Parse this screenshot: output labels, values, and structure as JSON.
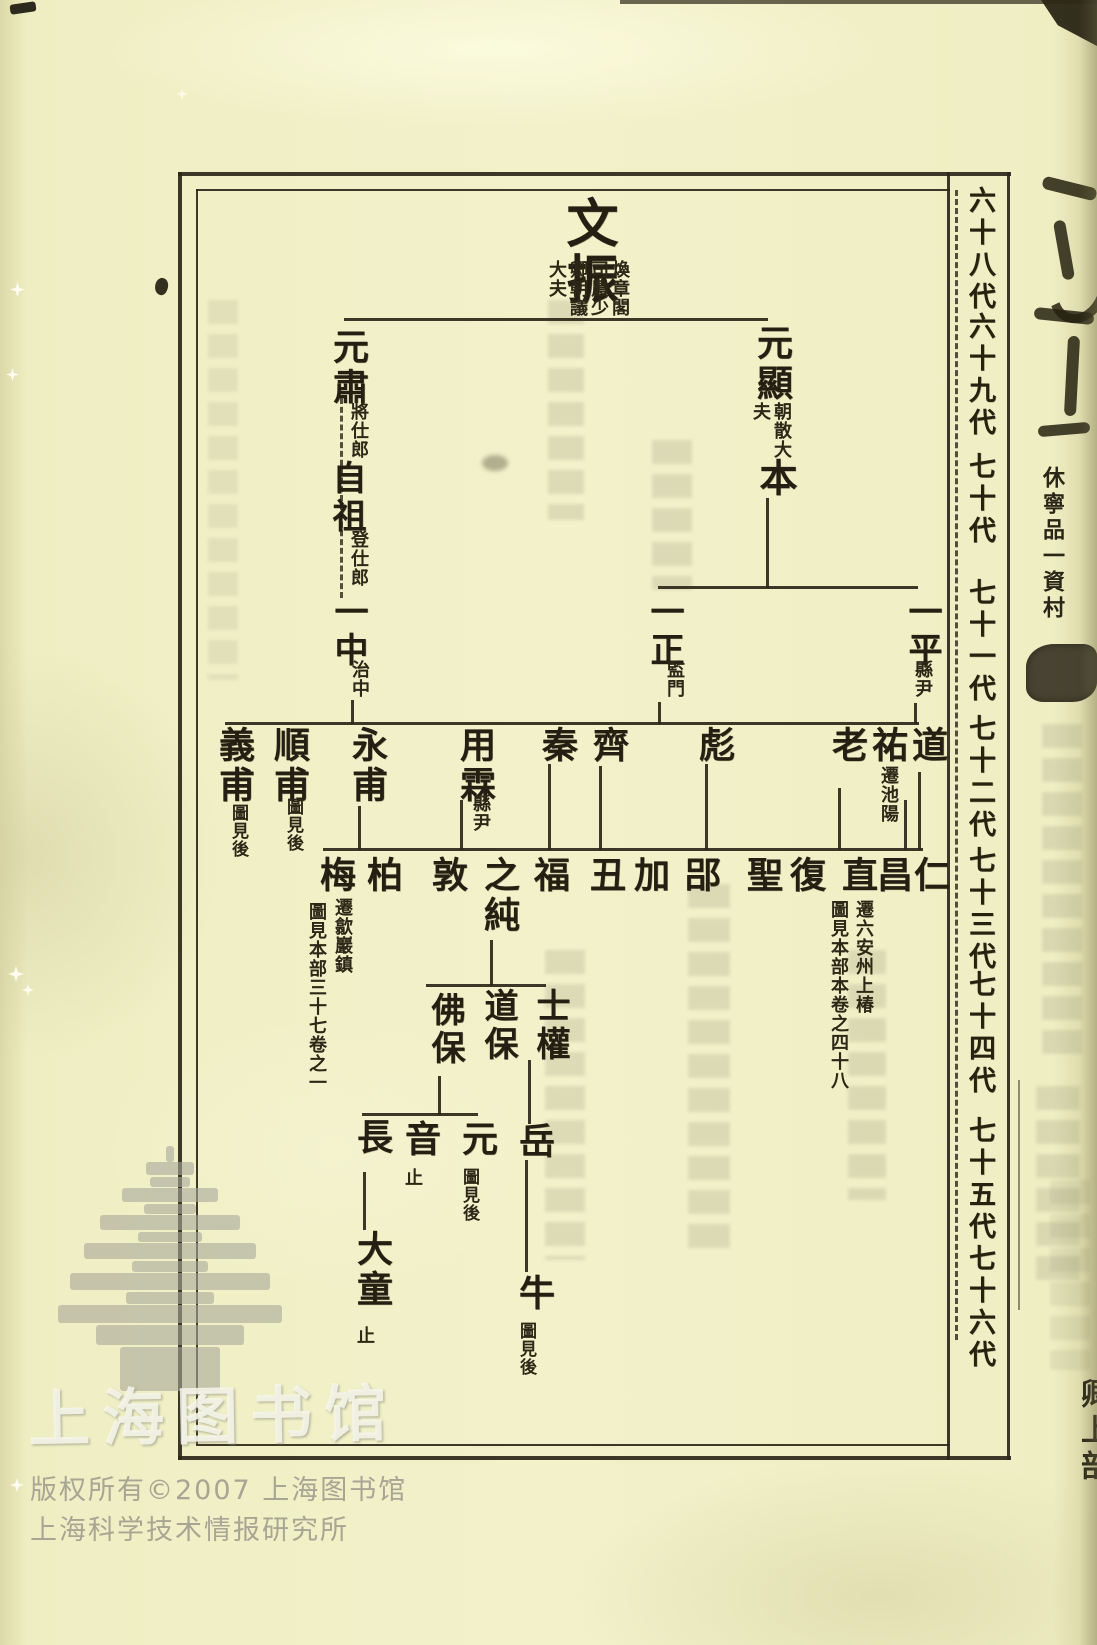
{
  "generations": [
    "六十八代",
    "六十九代",
    "七十代",
    "七十一代",
    "七十二代",
    "七十三代",
    "七十四代",
    "七十五代",
    "七十六代"
  ],
  "tree": {
    "wenzhen": {
      "name": "文振",
      "title": "煥章閣司農少卿朝議大夫"
    },
    "yuanxian": {
      "name": "元顯",
      "title": "朝散大夫"
    },
    "yuansu": {
      "name": "元肅",
      "title": "將仕郎"
    },
    "ben": {
      "name": "本"
    },
    "zizu": {
      "name": "自祖",
      "title": "登仕郎"
    },
    "yizhong": {
      "name": "一中",
      "title": "治中"
    },
    "yizheng": {
      "name": "一正",
      "title": "監門"
    },
    "yiping": {
      "name": "一平",
      "title": "縣尹"
    },
    "dao": {
      "name": "道"
    },
    "you": {
      "name": "祐",
      "note": "遷池陽"
    },
    "lao": {
      "name": "老"
    },
    "biao": {
      "name": "彪"
    },
    "qi": {
      "name": "齊"
    },
    "qin": {
      "name": "秦"
    },
    "yonglin": {
      "name": "用霖",
      "title": "縣尹"
    },
    "yongfu": {
      "name": "永甫"
    },
    "shunfu": {
      "name": "順甫",
      "note": "圖見後"
    },
    "yifu": {
      "name": "義甫",
      "note": "圖見後"
    },
    "ren": {
      "name": "仁"
    },
    "chang": {
      "name": "昌"
    },
    "zhi": {
      "name": "直",
      "note": "遷六安州上椿",
      "note2": "圖見本部本卷之四十八"
    },
    "fuA": {
      "name": "復"
    },
    "sheng": {
      "name": "聖"
    },
    "lyu": {
      "name": "郘"
    },
    "jia": {
      "name": "加"
    },
    "chou": {
      "name": "丑"
    },
    "fuB": {
      "name": "福"
    },
    "zhichun": {
      "name": "之純"
    },
    "dun": {
      "name": "敦"
    },
    "bai": {
      "name": "柏"
    },
    "mei": {
      "name": "梅",
      "note": "遷歙巖鎮",
      "note2": "圖見本部三十七卷之一"
    },
    "shiquan": {
      "name": "士權"
    },
    "daobao": {
      "name": "道保"
    },
    "fobao": {
      "name": "佛保"
    },
    "yue": {
      "name": "岳"
    },
    "yuan": {
      "name": "元",
      "note": "圖見後"
    },
    "yin": {
      "name": "音",
      "note": "止"
    },
    "zhang": {
      "name": "長"
    },
    "datong": {
      "name": "大童",
      "note": "止"
    },
    "niu": {
      "name": "牛",
      "note": "圖見後"
    }
  },
  "margin": {
    "volume_title": "休寧品一資村",
    "corner_label": "卿上部"
  },
  "watermark": {
    "library_script": "上海图书馆",
    "copyright": "版权所有©2007 上海图书馆",
    "institute": "上海科学技术情报研究所"
  }
}
